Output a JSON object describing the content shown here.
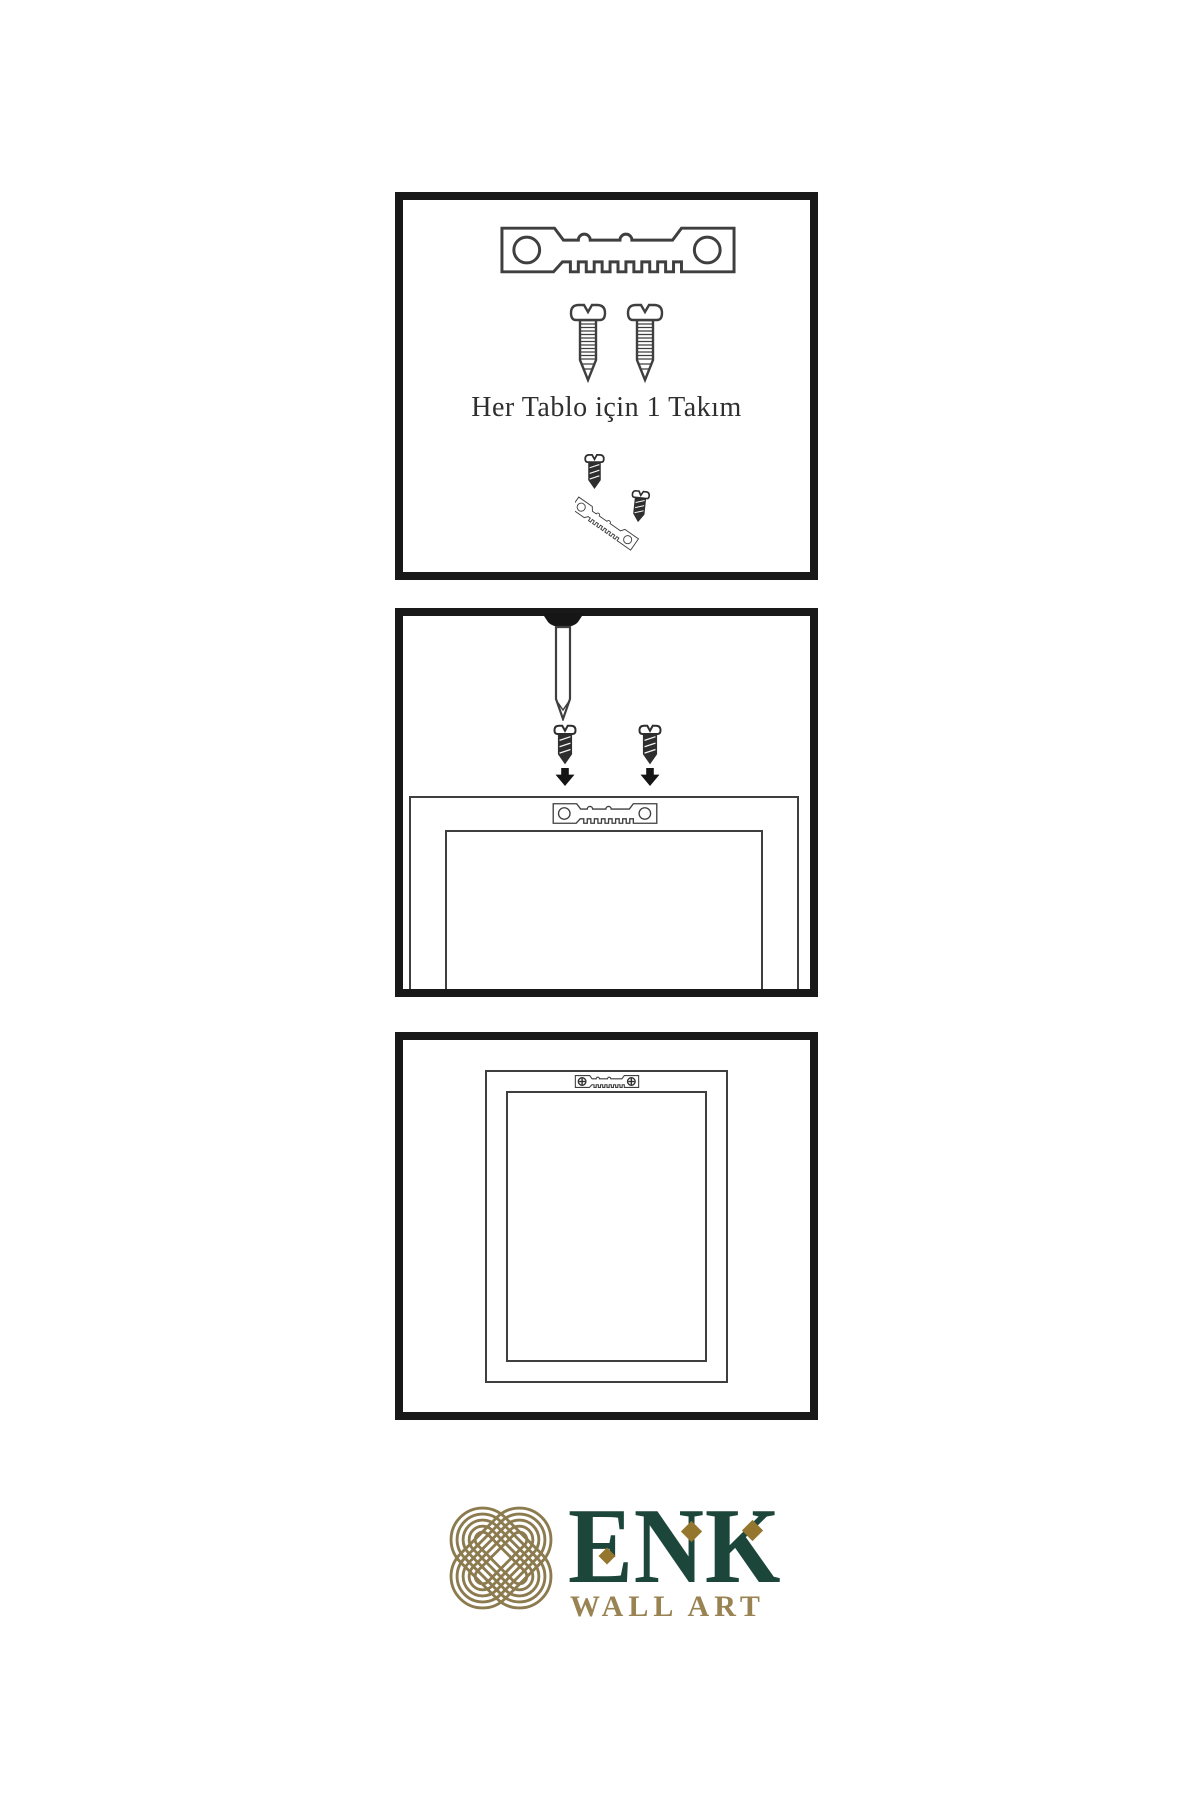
{
  "document": {
    "type": "wall-art-mounting-instructions",
    "background": "#ffffff"
  },
  "panels": [
    {
      "id": "kit",
      "caption": "Her Tablo için 1 Takım",
      "items": [
        "sawtooth-hanger",
        "screw",
        "screw",
        "screw-into-hanger-detail"
      ]
    },
    {
      "id": "mounting",
      "items": [
        "wall-nail",
        "screw-with-down-arrow",
        "screw-with-down-arrow",
        "sawtooth-hanger-on-frame-back",
        "frame-back-outline"
      ]
    },
    {
      "id": "mounted",
      "items": [
        "frame-back-outline",
        "sawtooth-hanger-screwed"
      ]
    }
  ],
  "icons": {
    "sawtooth-hanger": "metal strip with two round holes and sawtooth edge",
    "screw": "outlined threaded screw with notched round head",
    "dark-screw": "dark filled screw with notched head",
    "wall-nail": "nail driven down from top edge",
    "down-arrow": "solid black downward arrow",
    "phillips-screw-head": "circle with cross",
    "knot-logo": "interlaced gold celtic knot in diamond orientation"
  },
  "logo": {
    "brand": "ENK",
    "tagline": "WALL ART"
  },
  "colors": {
    "panel_border": "#191919",
    "diagram_line": "#3f3f3f",
    "dark_fill": "#2e2e2e",
    "caption_text": "#2f2f2f",
    "logo_green": "#1c463a",
    "logo_knot_gold": "#8c7b4e",
    "logo_tagline_gold": "#9a8352",
    "logo_diamond_gold": "#94762f"
  }
}
